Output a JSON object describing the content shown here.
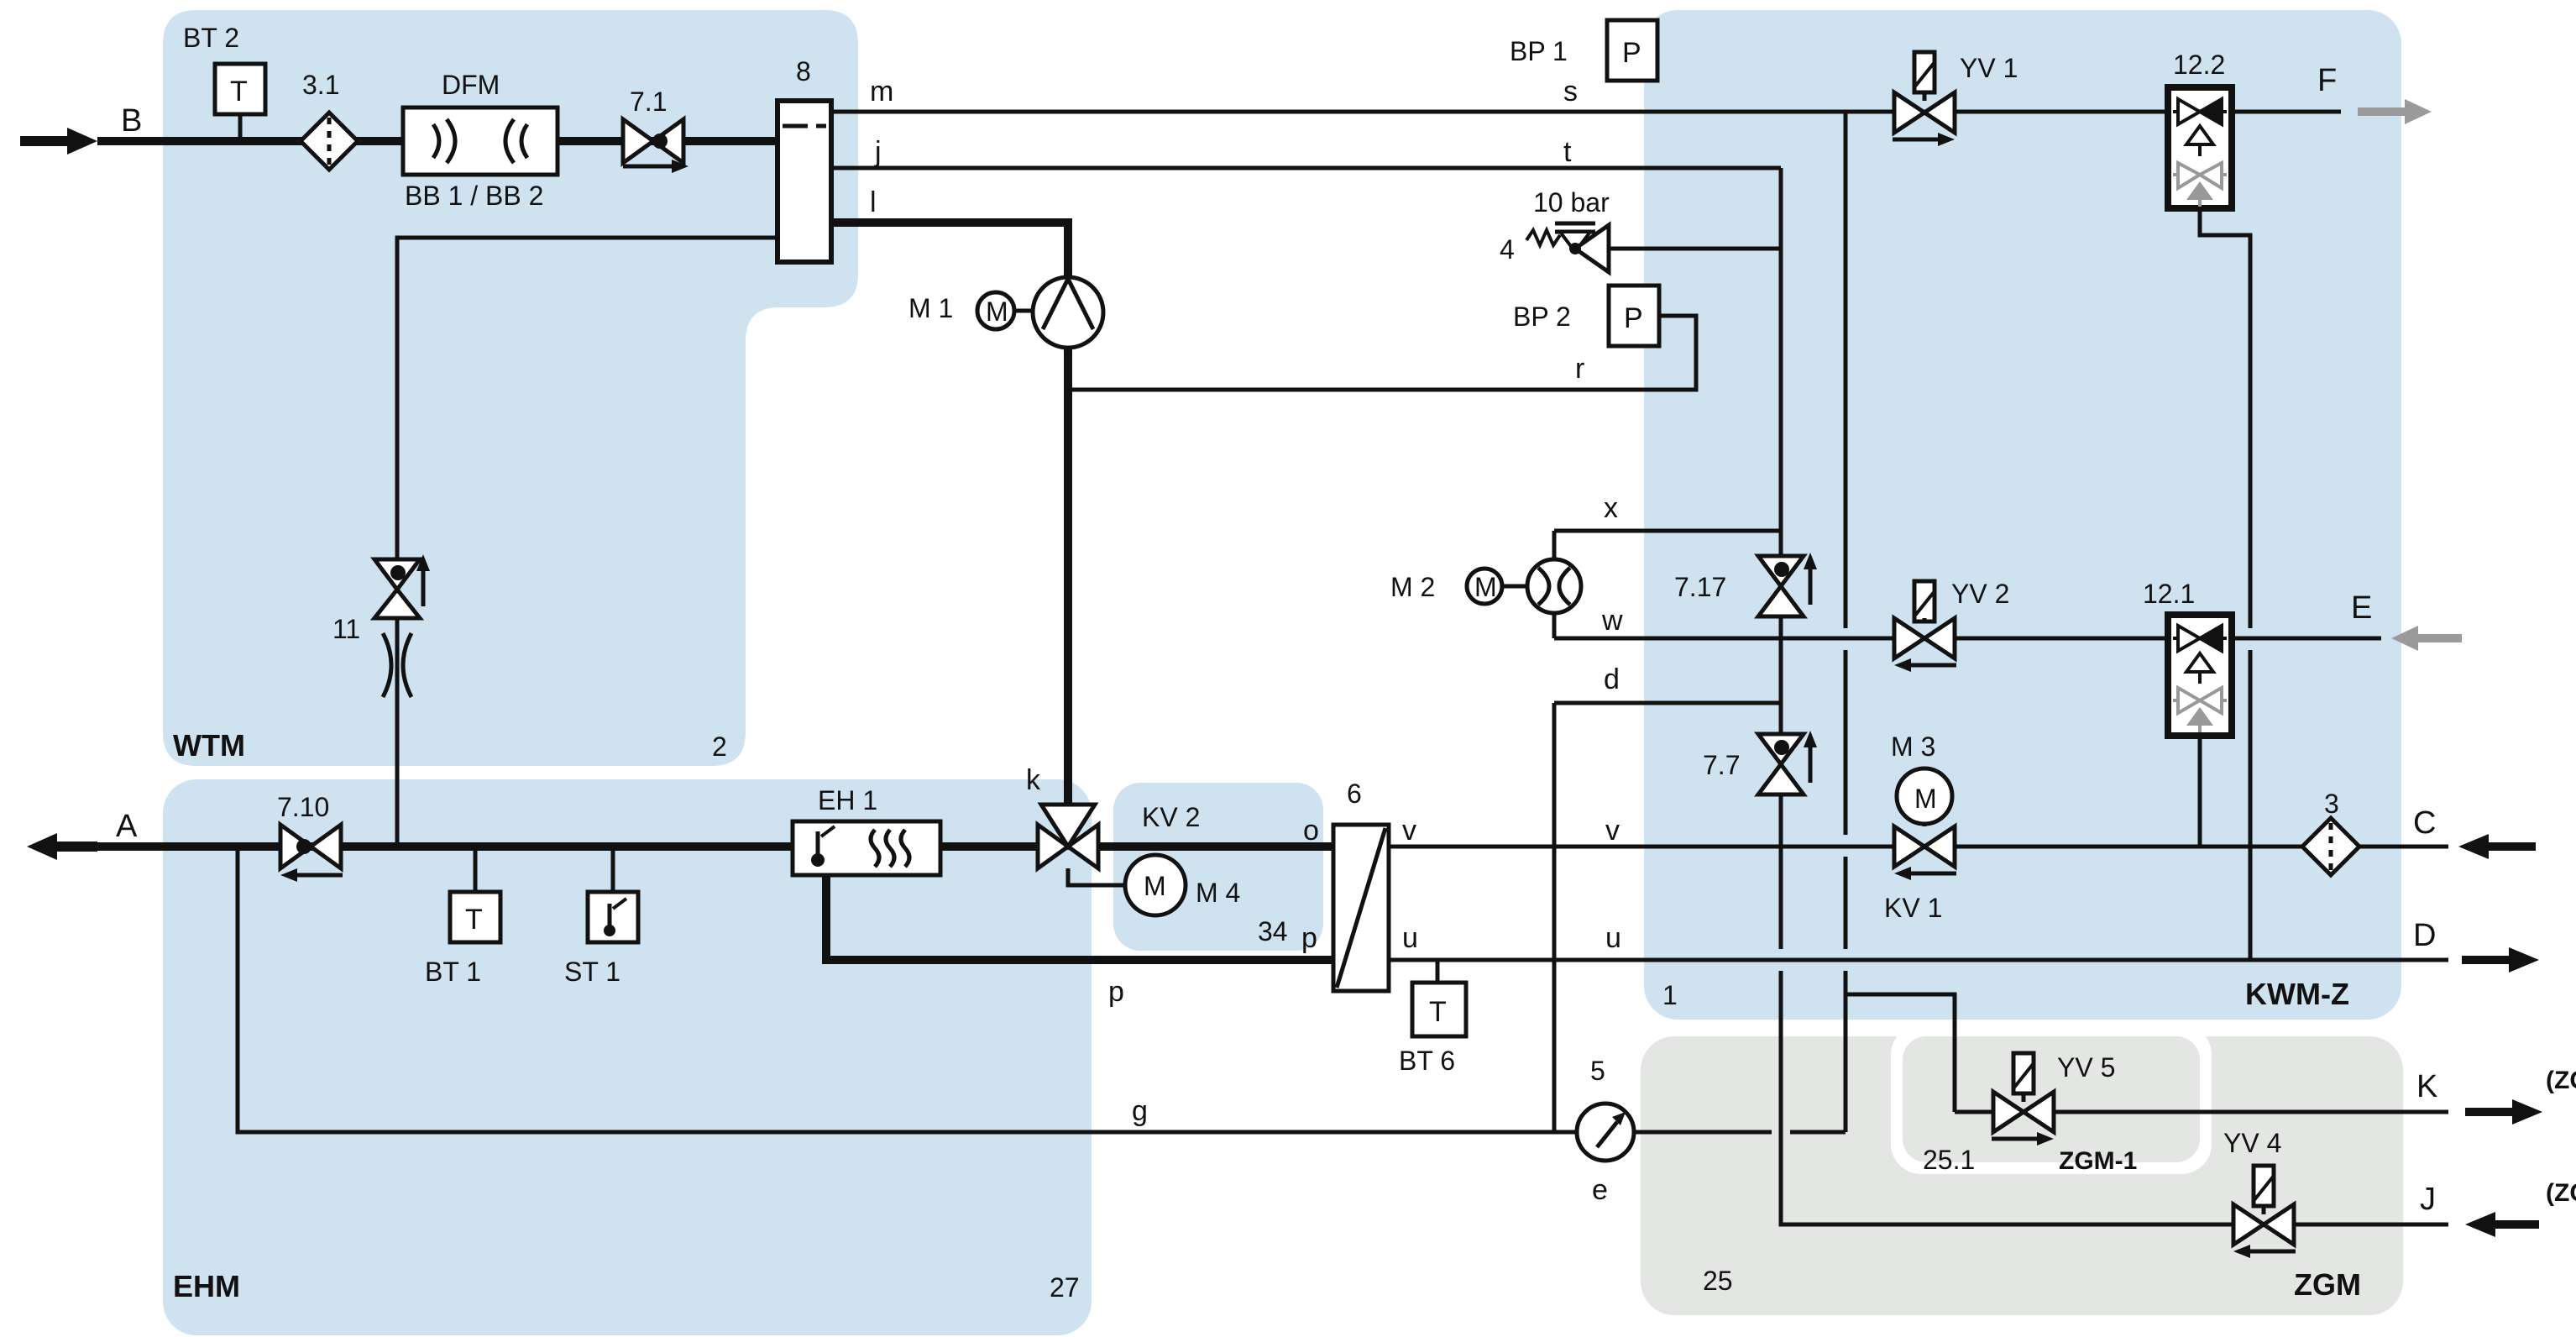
{
  "title": "Fluid system schematic (WTM / EHM / KWM-Z / ZGM modules)",
  "colors": {
    "module_blue": "#cfe2f0",
    "module_gray": "#e4e6e4",
    "line_black": "#111111",
    "inactive_gray": "#999999"
  },
  "regions": {
    "wtm": "WTM",
    "wtm_num": "2",
    "ehm": "EHM",
    "ehm_num": "27",
    "kwmz": "KWM-Z",
    "kwmz_num": "1",
    "zgm": "ZGM",
    "zgm_num": "25",
    "zgm1": "ZGM-1",
    "zgm1_num": "25.1"
  },
  "ports": {
    "a": "A",
    "b": "B",
    "c": "C",
    "d_out": "D",
    "e_out": "E",
    "f": "F",
    "j": "J",
    "k_out": "K",
    "zg": "(ZG)",
    "m": "m",
    "j_line": "j",
    "l": "l",
    "s": "s",
    "t": "t",
    "r": "r",
    "x": "x",
    "w": "w",
    "d": "d",
    "k": "k",
    "o": "o",
    "p": "p",
    "v": "v",
    "u": "u",
    "g": "g",
    "e": "e"
  },
  "components": {
    "bt2": "BT 2",
    "bt1": "BT 1",
    "bt6": "BT 6",
    "st1": "ST 1",
    "t_sensor": "T",
    "filter31": "3.1",
    "filter3": "3",
    "dfm": "DFM",
    "bb": "BB 1 / BB 2",
    "v71": "7.1",
    "v710": "7.10",
    "v717": "7.17",
    "v77": "7.7",
    "v11": "11",
    "v4": "4",
    "relief_rating": "10 bar",
    "block8": "8",
    "block6": "6",
    "gauge5": "5",
    "bp1": "BP 1",
    "bp2": "BP 2",
    "p_sensor": "P",
    "m1": "M 1",
    "m2": "M 2",
    "m3": "M 3",
    "m4": "M 4",
    "m4_num": "34",
    "motor": "M",
    "kv1": "KV 1",
    "kv2": "KV 2",
    "yv1": "YV 1",
    "yv2": "YV 2",
    "yv4": "YV 4",
    "yv5": "YV 5",
    "eh1": "EH 1",
    "c122": "12.2",
    "c121": "12.1"
  }
}
